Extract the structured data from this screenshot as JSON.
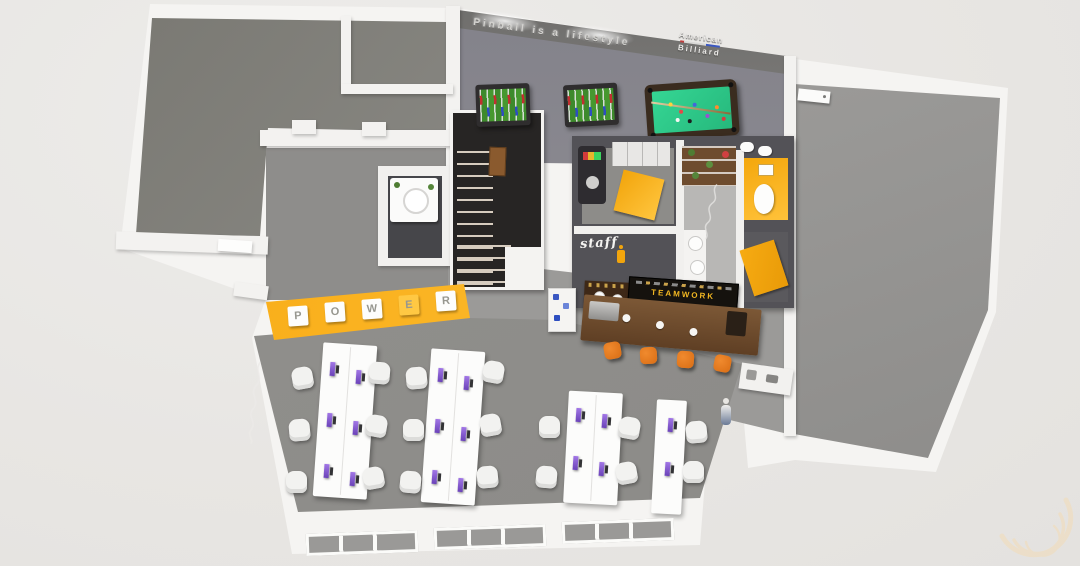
{
  "title": "3D bird's-eye render of an office floor plan",
  "wall_art": {
    "games_slogan": "Pinball is a lifestyle",
    "brand": {
      "line1": "American",
      "line2": "Billiard"
    },
    "power_sign": {
      "letters": [
        "P",
        "O",
        "W",
        "E",
        "R"
      ]
    },
    "staff_label": "staff",
    "bar_menu_title": "TEAMWORK"
  },
  "icons": {
    "watermark": "crescent-swoosh",
    "staff_figure": "person-pictogram"
  },
  "colors": {
    "background": "#e9e7e4",
    "walls": "#f3f2f0",
    "floor_gray": "#8f8e8b",
    "accent_yellow": "#f7a90e",
    "bar_wood": "#6e4a2c",
    "menu_board": "#15120e",
    "menu_text_yellow": "#f2b722",
    "pool_felt": "#2ed08e",
    "foosball_green": "#3d8a2c",
    "stool_orange": "#e0761d",
    "monitor_purple": "#7d55cb",
    "stairs_dark": "#272524",
    "watermark_cream": "#f2dcb8"
  },
  "furniture_counts": {
    "office_desks": 4,
    "office_chairs": 18,
    "monitors": 16,
    "bar_stools": 4,
    "foosball_tables": 2,
    "pool_tables": 1,
    "bathroom_sinks": 3
  }
}
